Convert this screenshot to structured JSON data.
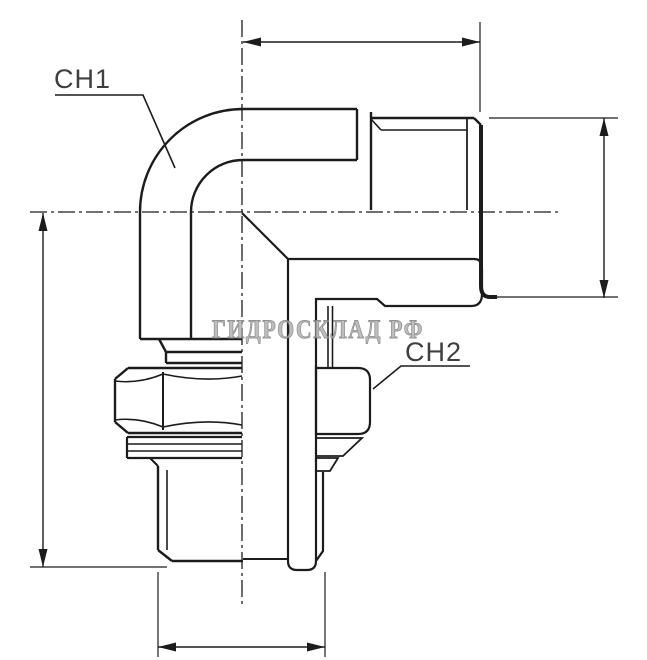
{
  "drawing": {
    "type_note": "technical-section-drawing",
    "labels": {
      "ch1": "CH1",
      "ch2": "CH2"
    },
    "watermark": "ГИДРОСКЛАД РФ",
    "colors": {
      "line": "#1c1c1c",
      "label": "#3f3f3f",
      "watermark_fill": "#b3b3b3",
      "watermark_stroke": "#7f7f7f",
      "background": "#ffffff"
    }
  }
}
